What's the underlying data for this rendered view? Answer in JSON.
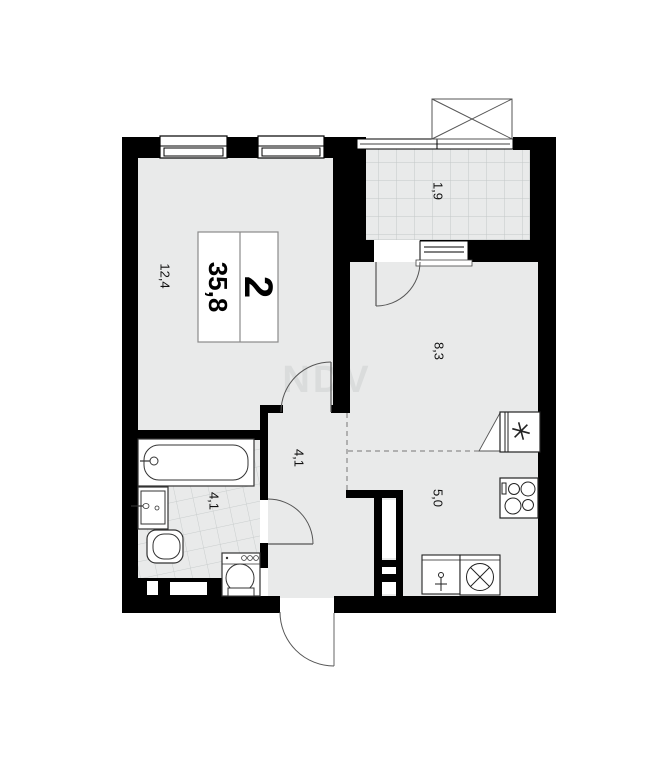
{
  "plan": {
    "watermark": "NDV",
    "summary_box": {
      "rooms_count": "2",
      "total_area": "35,8"
    },
    "room_labels": {
      "living_room": "12,4",
      "balcony": "1,9",
      "kitchen_living": "8,3",
      "hallway": "4,1",
      "bathroom": "4,1",
      "kitchen": "5,0"
    },
    "colors": {
      "wall": "#000000",
      "floor": "#e9eaea",
      "tile_line": "#c4c8c8",
      "watermark": "#dadcdc"
    }
  }
}
